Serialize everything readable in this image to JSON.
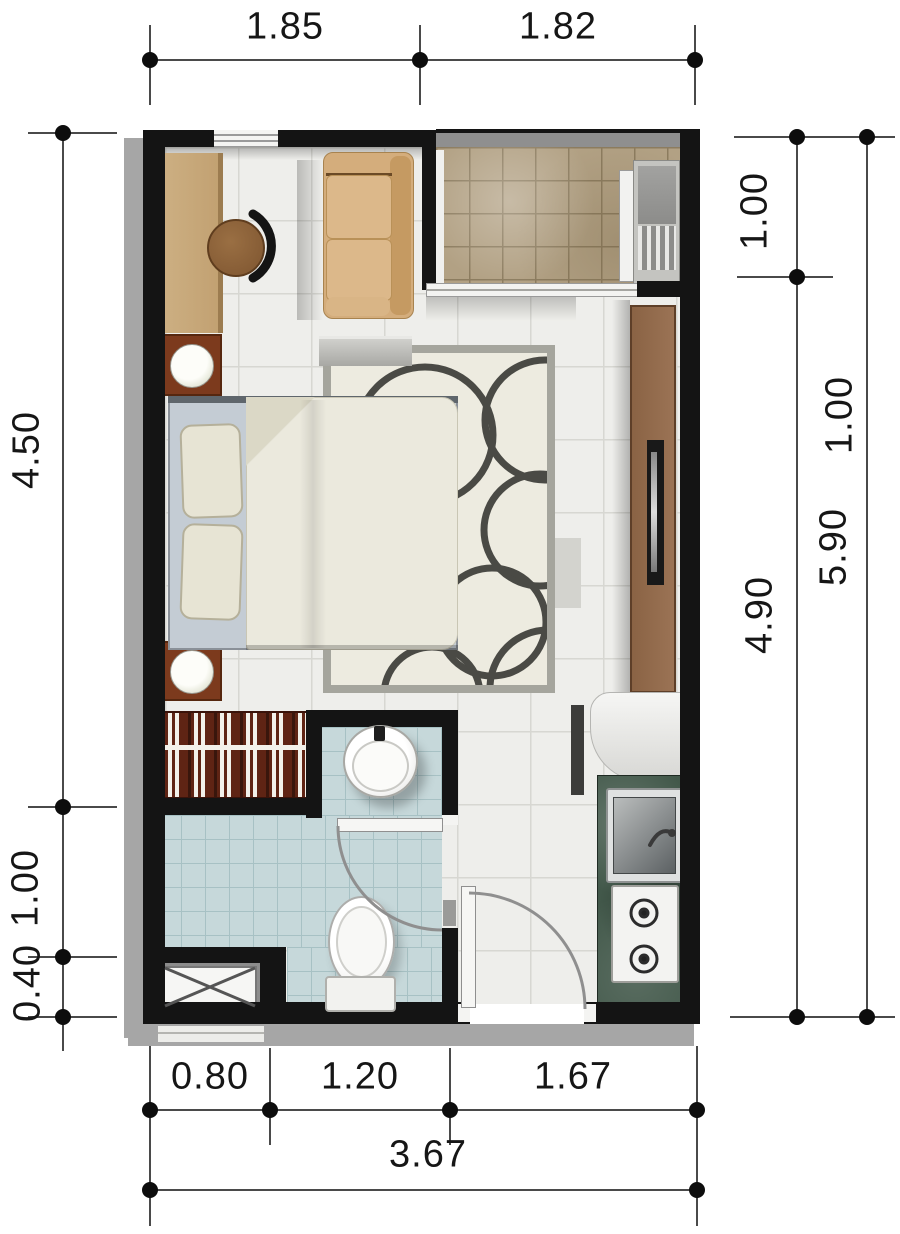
{
  "title": "studio-apartment-floor-plan",
  "dimensions_m": {
    "top": [
      "1.85",
      "1.82"
    ],
    "left": [
      "4.50",
      "1.00",
      "0.40"
    ],
    "right_inner": [
      "1.00",
      "4.90"
    ],
    "right_outer": [
      "1.00",
      "5.90"
    ],
    "bottom": [
      "0.80",
      "1.20",
      "1.67"
    ],
    "bottom_total": "3.67"
  },
  "palette": {
    "wall": "#141414",
    "floor_tile": "#eeeeeb",
    "balcony_tile": "#b2a184",
    "bathroom_tile": "#c6d8da",
    "desk_wood": "#c9aa7c",
    "nightstand_wood": "#7c3a1d",
    "sofa": "#d4ad7c",
    "console_wood": "#96704e",
    "kitchen_counter": "#42584a",
    "rug_field": "#edebe0",
    "rug_ring": "#4a4a45",
    "bed_linen": "#ebe9dd",
    "dimension_text": "#161616"
  }
}
